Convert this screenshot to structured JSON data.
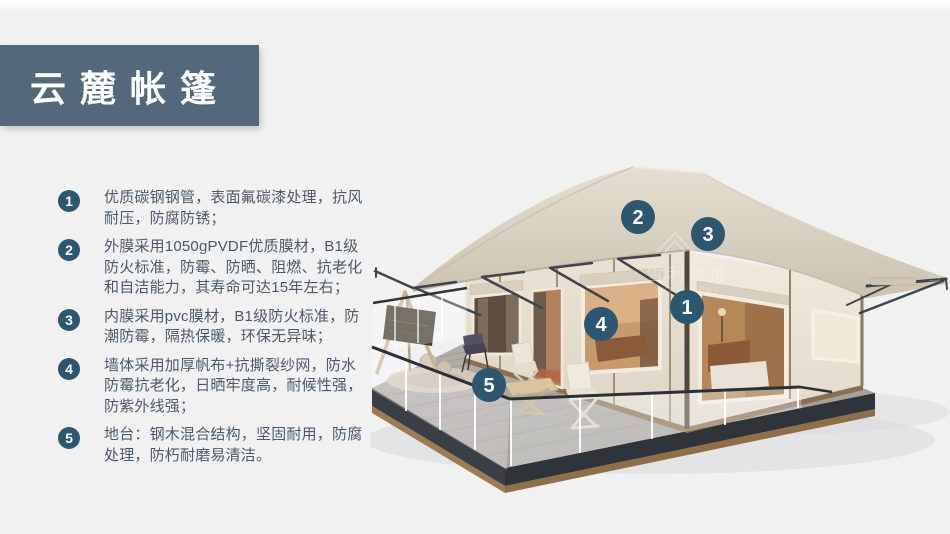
{
  "title": {
    "text": "云麓帐篷"
  },
  "features": [
    {
      "num": "1",
      "text": "优质碳钢钢管，表面氟碳漆处理，抗风耐压，防腐防锈；"
    },
    {
      "num": "2",
      "text": "外膜采用1050gPVDF优质膜材，B1级防火标准，防霉、防晒、阻燃、抗老化和自洁能力，其寿命可达15年左右；"
    },
    {
      "num": "3",
      "text": "内膜采用pvc膜材，B1级防火标准，防潮防霉，隔热保暖，环保无异味；"
    },
    {
      "num": "4",
      "text": "墙体采用加厚帆布+抗撕裂纱网，防水防霉抗老化，日晒牢度高，耐候性强，防紫外线强；"
    },
    {
      "num": "5",
      "text": "地台：钢木混合结构，坚固耐用，防腐处理，防朽耐磨易清洁。"
    }
  ],
  "markers": [
    {
      "label": "1"
    },
    {
      "label": "2"
    },
    {
      "label": "3"
    },
    {
      "label": "4"
    },
    {
      "label": "5"
    }
  ],
  "watermark": {
    "cn": "雪利篷房",
    "en": "YUELI TENT",
    "cn_partial": "雪利"
  },
  "colors": {
    "background": "#f1f1f2",
    "banner": "#54687c",
    "badge": "#2d566f",
    "body_text": "#4b5a6a",
    "roof": "#d9d1c2",
    "wall": "#e9e2d4",
    "deck": "#a9a59f",
    "frame_metal": "#3f444b"
  }
}
